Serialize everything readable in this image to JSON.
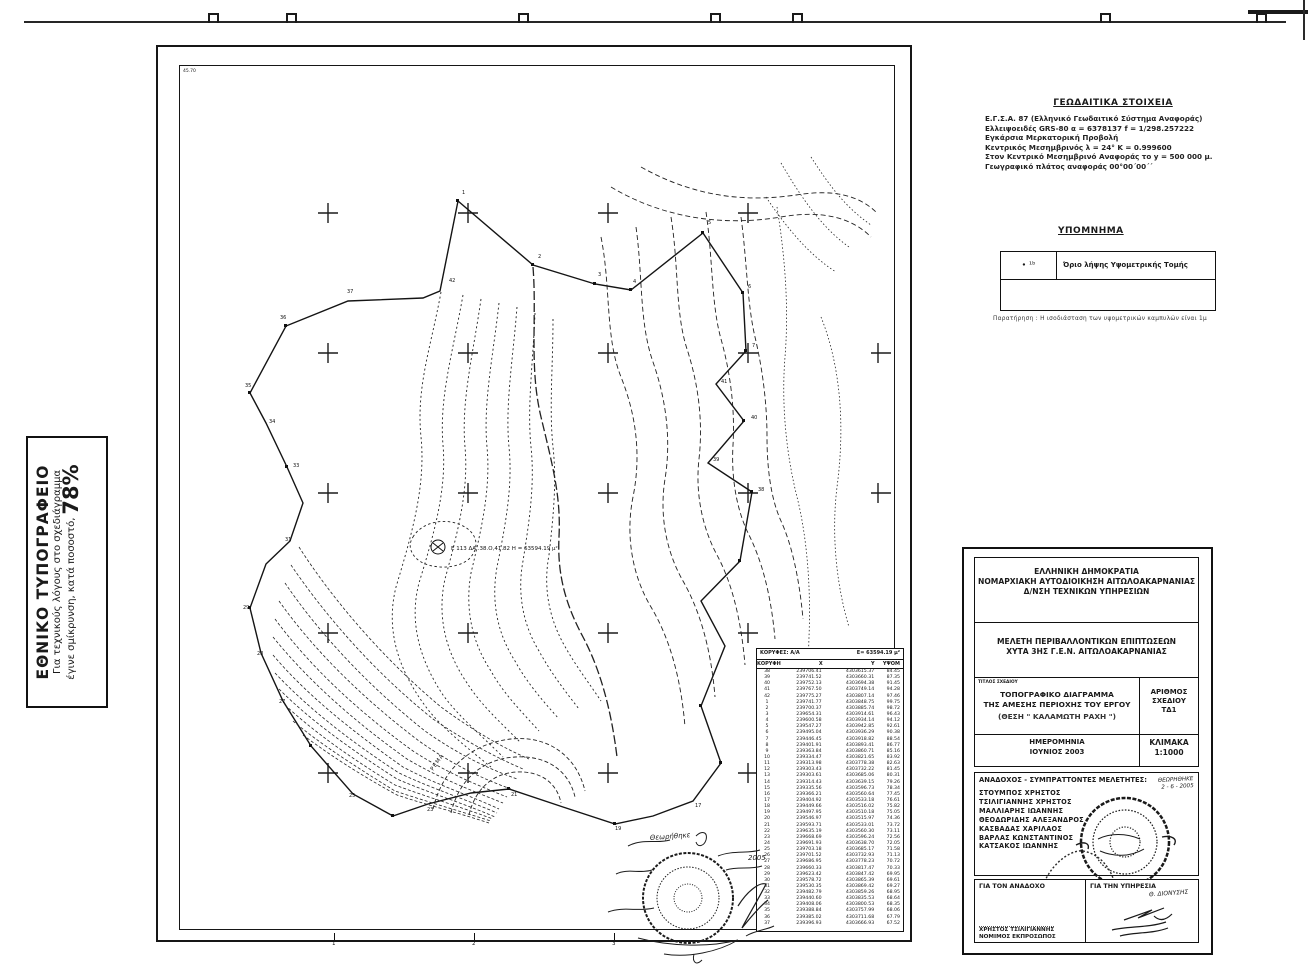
{
  "print_note": {
    "title": "ΕΘΝΙΚΟ ΤΥΠΟΓΡΑΦΕΙΟ",
    "line1": "Για τεχνικούς λόγους στο σχεδιάγραμμα",
    "line2": "έγινε σμίκρυνση, κατά ποσοστό,",
    "percent": "78%"
  },
  "geodetic": {
    "title": "ΓΕΩΔΑΙΤΙΚΑ ΣΤΟΙΧΕΙΑ",
    "lines": [
      "Ε.Γ.Σ.Α. 87 (Ελληνικό Γεωδαιτικό Σύστημα Αναφοράς)",
      "Ελλειψοειδές GRS-80  α = 6378137     f = 1/298.257222",
      "Εγκάρσια Μερκατορική Προβολή",
      "Κεντρικός Μεσημβρινός λ = 24°  Κ = 0.999600",
      "Στον Κεντρικό Μεσημβρινό Αναφοράς το y = 500 000 μ.",
      "Γεωγραφικό πλάτος αναφοράς 00°00΄00΄΄"
    ]
  },
  "legend": {
    "title": "ΥΠΟΜΝΗΜΑ",
    "symbol": "∙ ¹ᵇ",
    "label": "Όριο λήψης Υψομετρικής Τομής",
    "note": "Παρατήρηση : Η ισοδιάσταση των υψομετρικών καμπυλών είναι 1μ"
  },
  "map": {
    "corner_label": "45.70",
    "area_label": "Ε 113 ΔΑ..38.Ο,41.82 Η = 63594.19 μ²",
    "stream_label": "ΡΕΜΑ",
    "stamp_script": "Θεωρήθηκε",
    "stamp_date": "2005",
    "scale_ticks": [
      "1",
      "2",
      "3"
    ],
    "point_labels": [
      "1",
      "2",
      "3",
      "4",
      "5",
      "6",
      "7",
      "41",
      "40",
      "39",
      "38",
      "42",
      "37",
      "36",
      "35",
      "34",
      "33",
      "31",
      "29",
      "28",
      "27",
      "25",
      "23",
      "21",
      "19",
      "17"
    ]
  },
  "coords_table": {
    "header_left": "ΚΟΡΥΦΕΣ: Α/Α",
    "header_right": "Ε= 63594.19 μ²",
    "columns": [
      "ΚΟΡΥΦΗ",
      "X",
      "Y",
      "ΥΨΟΜ"
    ],
    "rows": [
      [
        "38",
        "239706.41",
        "4303615.37",
        "84.45"
      ],
      [
        "39",
        "239741.52",
        "4303660.31",
        "87.35"
      ],
      [
        "40",
        "239752.13",
        "4303694.38",
        "91.45"
      ],
      [
        "41",
        "239767.50",
        "4303749.14",
        "94.28"
      ],
      [
        "42",
        "239775.27",
        "4303807.14",
        "97.46"
      ],
      [
        "1",
        "239741.77",
        "4303848.75",
        "99.75"
      ],
      [
        "2",
        "239700.37",
        "4303885.74",
        "98.72"
      ],
      [
        "3",
        "239654.31",
        "4303914.61",
        "96.43"
      ],
      [
        "4",
        "239600.58",
        "4303934.14",
        "94.12"
      ],
      [
        "5",
        "239547.27",
        "4303942.85",
        "92.61"
      ],
      [
        "6",
        "239495.04",
        "4303936.29",
        "90.38"
      ],
      [
        "7",
        "239446.45",
        "4303918.82",
        "88.54"
      ],
      [
        "8",
        "239401.91",
        "4303893.41",
        "86.77"
      ],
      [
        "9",
        "239363.84",
        "4303860.71",
        "85.16"
      ],
      [
        "10",
        "239334.47",
        "4303821.65",
        "83.92"
      ],
      [
        "11",
        "239313.98",
        "4303778.38",
        "82.63"
      ],
      [
        "12",
        "239303.43",
        "4303732.22",
        "81.45"
      ],
      [
        "13",
        "239303.61",
        "4303685.06",
        "80.31"
      ],
      [
        "14",
        "239314.43",
        "4303639.15",
        "79.26"
      ],
      [
        "15",
        "239335.56",
        "4303596.73",
        "78.34"
      ],
      [
        "16",
        "239366.21",
        "4303560.64",
        "77.45"
      ],
      [
        "17",
        "239404.92",
        "4303533.18",
        "76.61"
      ],
      [
        "18",
        "239449.66",
        "4303516.02",
        "75.82"
      ],
      [
        "19",
        "239497.95",
        "4303510.18",
        "75.05"
      ],
      [
        "20",
        "239546.97",
        "4303515.97",
        "74.36"
      ],
      [
        "21",
        "239593.71",
        "4303533.01",
        "73.72"
      ],
      [
        "22",
        "239635.19",
        "4303560.30",
        "73.11"
      ],
      [
        "23",
        "239668.69",
        "4303596.24",
        "72.56"
      ],
      [
        "24",
        "239691.93",
        "4303638.70",
        "72.05"
      ],
      [
        "25",
        "239703.18",
        "4303685.17",
        "71.58"
      ],
      [
        "26",
        "239701.52",
        "4303732.93",
        "71.13"
      ],
      [
        "27",
        "239686.95",
        "4303778.23",
        "70.72"
      ],
      [
        "28",
        "239660.33",
        "4303817.47",
        "70.33"
      ],
      [
        "29",
        "239623.42",
        "4303847.42",
        "69.95"
      ],
      [
        "30",
        "239578.72",
        "4303865.39",
        "69.61"
      ],
      [
        "31",
        "239530.35",
        "4303869.42",
        "69.27"
      ],
      [
        "32",
        "239482.79",
        "4303859.26",
        "68.95"
      ],
      [
        "33",
        "239440.60",
        "4303835.53",
        "68.64"
      ],
      [
        "34",
        "239408.06",
        "4303800.53",
        "68.35"
      ],
      [
        "35",
        "239388.84",
        "4303757.99",
        "68.06"
      ],
      [
        "36",
        "239385.02",
        "4303711.68",
        "67.79"
      ],
      [
        "37",
        "239396.93",
        "4303666.93",
        "67.52"
      ]
    ]
  },
  "title_block": {
    "authority_lines": [
      "ΕΛΛΗΝΙΚΗ ΔΗΜΟΚΡΑΤΙΑ",
      "ΝΟΜΑΡΧΙΑΚΗ ΑΥΤΟΔΙΟΙΚΗΣΗ ΑΙΤΩΛΟΑΚΑΡΝΑΝΙΑΣ",
      "Δ/ΝΣΗ ΤΕΧΝΙΚΩΝ ΥΠΗΡΕΣΙΩΝ"
    ],
    "project_lines": [
      "ΜΕΛΕΤΗ ΠΕΡΙΒΑΛΛΟΝΤΙΚΩΝ ΕΠΙΠΤΩΣΕΩΝ",
      "ΧΥΤΑ 3ΗΣ Γ.Ε.Ν. ΑΙΤΩΛΟΑΚΑΡΝΑΝΙΑΣ"
    ],
    "drawing_title_label": "ΤΙΤΛΟΣ ΣΧΕΔΙΟΥ",
    "drawing_title_lines": [
      "ΤΟΠΟΓΡΑΦΙΚΟ ΔΙΑΓΡΑΜΜΑ",
      "ΤΗΣ ΑΜΕΣΗΣ ΠΕΡΙΟΧΗΣ ΤΟΥ ΕΡΓΟΥ"
    ],
    "location_line": "(ΘΕΣΗ \" ΚΑΛΑΜΩΤΗ ΡΑΧΗ \")",
    "number_label": "ΑΡΙΘΜΟΣ",
    "number_label2": "ΣΧΕΔΙΟΥ",
    "number_value": "ΤΔ1",
    "date_label": "ΗΜΕΡΟΜΗΝΙΑ",
    "date_value": "ΙΟΥΝΙΟΣ 2003",
    "scale_label": "ΚΛΙΜΑΚΑ",
    "scale_value": "1:1000",
    "consultants_label": "ΑΝΑΔΟΧΟΣ - ΣΥΜΠΡΑΤΤΟΝΤΕΣ ΜΕΛΕΤΗΤΕΣ:",
    "approved_script": "ΘΕΩΡΗΘΗΚΕ",
    "approved_date": "2 - 6 - 2005",
    "consultants": [
      "ΣΤΟΥΜΠΟΣ ΧΡΗΣΤΟΣ",
      "ΤΣΙΛΙΓΙΑΝΝΗΣ ΧΡΗΣΤΟΣ",
      "ΜΑΛΛΙΑΡΗΣ ΙΩΑΝΝΗΣ",
      "ΘΕΟΔΩΡΙΔΗΣ ΑΛΕΞΑΝΔΡΟΣ",
      "ΚΑΣΒΑΔΑΣ ΧΑΡΙΛΑΟΣ",
      "ΒΑΡΛΑΣ ΚΩΝΣΤΑΝΤΙΝΟΣ",
      "ΚΑΤΣΑΚΟΣ ΙΩΑΝΝΗΣ"
    ],
    "for_contractor_label": "ΓΙΑ ΤΟΝ ΑΝΑΔΟΧΟ",
    "contractor_name": "ΧΡΗΣΤΟΣ ΤΣΙΛΙΓΙΑΝΝΗΣ",
    "contractor_role": "ΝΟΜΙΜΟΣ ΕΚΠΡΟΣΩΠΟΣ",
    "for_service_label": "ΓΙΑ ΤΗΝ ΥΠΗΡΕΣΙΑ",
    "service_script": "Θ. ΔΙΟΝΥΣΗΣ"
  }
}
